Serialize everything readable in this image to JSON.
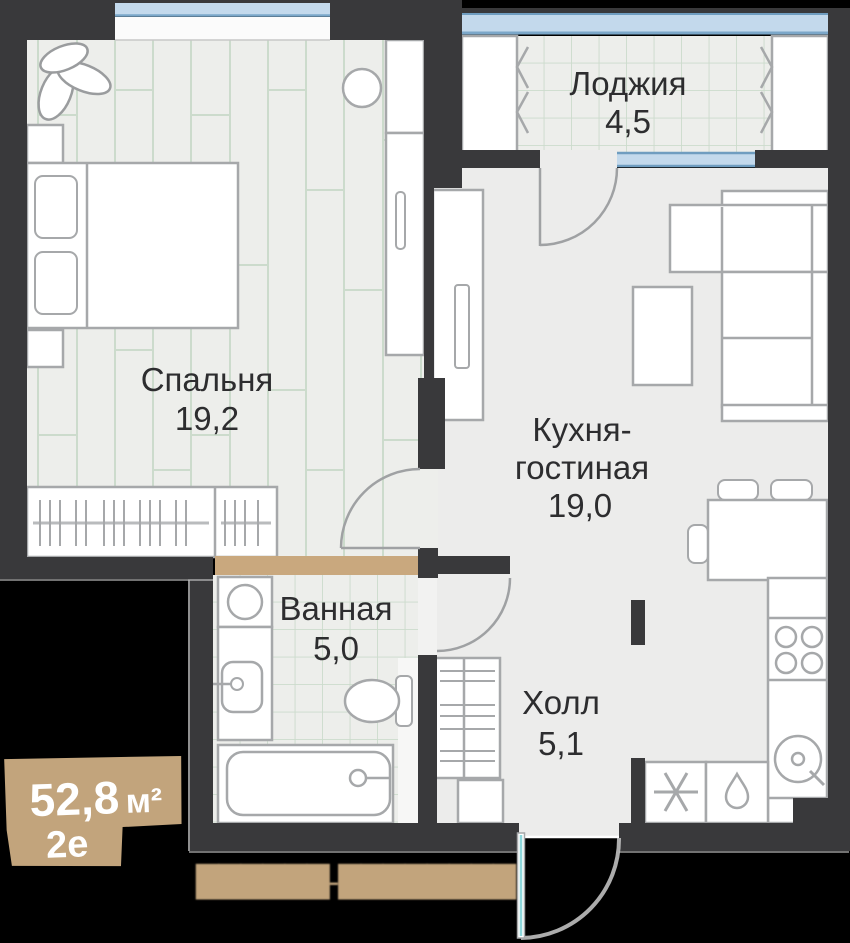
{
  "rooms": {
    "bedroom": {
      "name": "Спальня",
      "area": "19,2"
    },
    "kitchen_living": {
      "name_line1": "Кухня-",
      "name_line2": "гостиная",
      "area": "19,0"
    },
    "loggia": {
      "name": "Лоджия",
      "area": "4,5"
    },
    "bathroom": {
      "name": "Ванная",
      "area": "5,0"
    },
    "hall": {
      "name": "Холл",
      "area": "5,1"
    }
  },
  "badge": {
    "area_value": "52,8",
    "area_unit": "м²",
    "layout_code": "2е"
  },
  "watermark": {
    "text": "██████-████████"
  },
  "colors": {
    "background": "#000000",
    "wall": "#39393b",
    "floor": "#edeeeb",
    "pattern_line": "#ccdbcc",
    "furniture_stroke": "#a6a8aa",
    "window_blue": "#c3d9ec",
    "window_frame": "#6f9dc0",
    "accent_tan": "#c2a47c",
    "label_text": "#2d2d2f",
    "entrance_door_teal": "#8fd8dc"
  }
}
